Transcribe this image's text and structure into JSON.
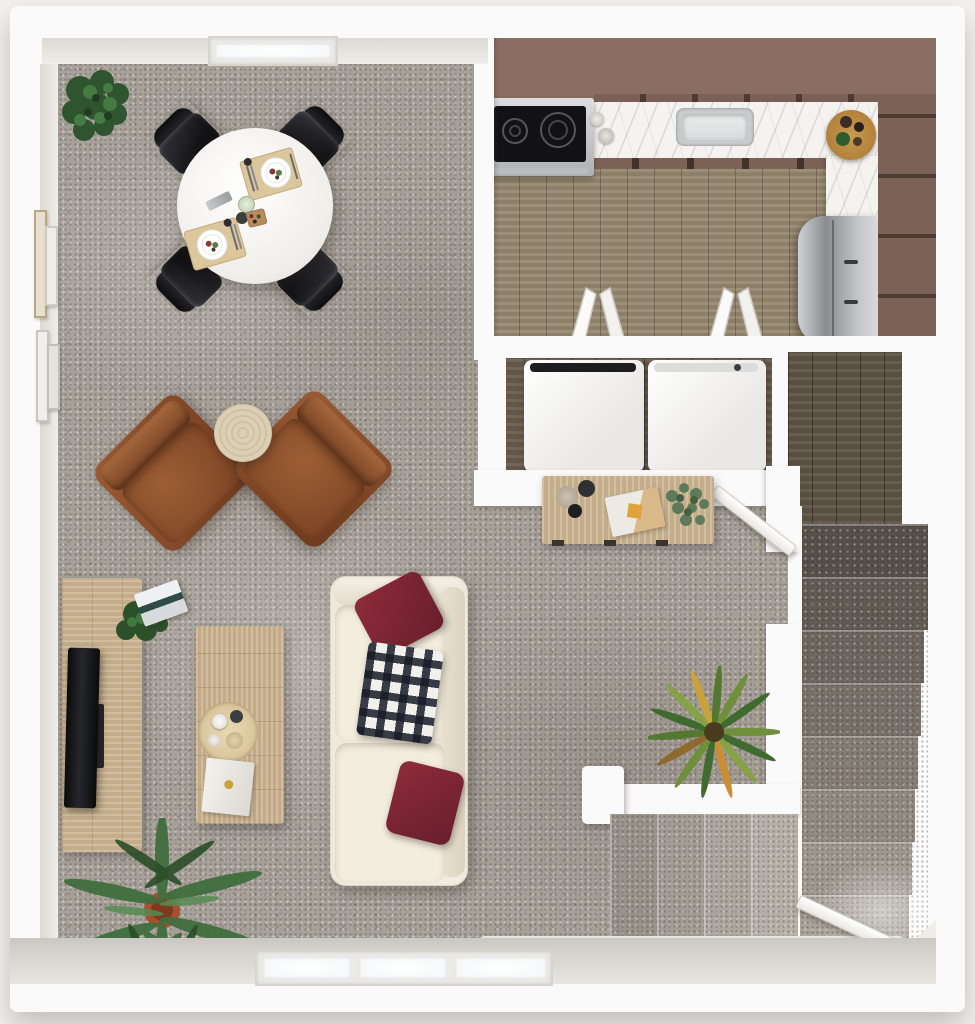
{
  "palette": {
    "pageBg": "#f3f2f0",
    "wallWhite": "#fbfafa",
    "wallFace": "#e7e5e0",
    "carpet": "#a7a199",
    "kitchenWood": "#96886f",
    "hallWood": "#5f5547",
    "closetWood": "#6b5e4f",
    "marble": "#f4f3f0",
    "mauve": "#8a6e64",
    "mauveDark": "#7c6157",
    "leather": "#8a4c2b",
    "sofaCream": "#efe9dc",
    "pillowRed": "#7e2434",
    "oakLight": "#cdb794",
    "steel": "#c7c9cb",
    "plantGreen": "#3c6b3c"
  },
  "scene": {
    "kind": "3D top-down apartment floor plan rendering",
    "rooms": [
      {
        "id": "dining",
        "label": "Dining area with carpet floor"
      },
      {
        "id": "living",
        "label": "Living room with carpet floor"
      },
      {
        "id": "kitchen",
        "label": "Kitchen with wood floor and mauve walls"
      },
      {
        "id": "laundry",
        "label": "Laundry closet with washer and dryer"
      },
      {
        "id": "hall",
        "label": "Stair hall with dark wood floor"
      },
      {
        "id": "stairs",
        "label": "Carpeted staircase descending"
      },
      {
        "id": "entry",
        "label": "Entry with steps and open front door"
      }
    ],
    "furniture": [
      {
        "id": "dining-table",
        "label": "Round white dining table with two place settings"
      },
      {
        "id": "dining-chairs",
        "label": "Four black dining chairs"
      },
      {
        "id": "armchair-left",
        "label": "Brown leather armchair"
      },
      {
        "id": "armchair-right",
        "label": "Brown leather armchair"
      },
      {
        "id": "side-table",
        "label": "Round travertine side table"
      },
      {
        "id": "sofa",
        "label": "Cream sofa with burgundy pillows and checkered throw"
      },
      {
        "id": "coffee-table",
        "label": "Light wood coffee table with tray and book"
      },
      {
        "id": "tv-console",
        "label": "Light wood media console"
      },
      {
        "id": "tv",
        "label": "Flat screen TV"
      },
      {
        "id": "desk",
        "label": "Wood console desk with clipboard, mugs and plant"
      }
    ],
    "fixtures": [
      {
        "id": "stove",
        "label": "Stainless range with black cooktop"
      },
      {
        "id": "sink",
        "label": "Stainless kitchen sink"
      },
      {
        "id": "fridge",
        "label": "Stainless refrigerator"
      },
      {
        "id": "counter",
        "label": "White marble L-shaped countertop"
      },
      {
        "id": "washer",
        "label": "White washer"
      },
      {
        "id": "dryer",
        "label": "White dryer"
      },
      {
        "id": "open-cabinets",
        "label": "Two open white cabinet doors"
      },
      {
        "id": "board",
        "label": "Round wooden serving board with jars"
      }
    ],
    "plants": [
      {
        "id": "fiddle-plant",
        "label": "Fiddle leaf plant in dining corner"
      },
      {
        "id": "console-plant",
        "label": "Plant on media console"
      },
      {
        "id": "palm-plant",
        "label": "Palm plant in terracotta pot"
      },
      {
        "id": "yucca-plant",
        "label": "Spiky yucca plant near stairs"
      },
      {
        "id": "desk-plant",
        "label": "Eucalyptus sprigs on desk"
      }
    ],
    "architecture": [
      {
        "id": "window-top",
        "label": "Window in top wall"
      },
      {
        "id": "window-bottom",
        "label": "Triple window in bottom wall"
      },
      {
        "id": "wall-frames",
        "label": "Framed art pairs on left wall"
      },
      {
        "id": "interior-door",
        "label": "Open interior door to stair hall"
      },
      {
        "id": "front-door",
        "label": "Open front door at entry"
      }
    ]
  }
}
